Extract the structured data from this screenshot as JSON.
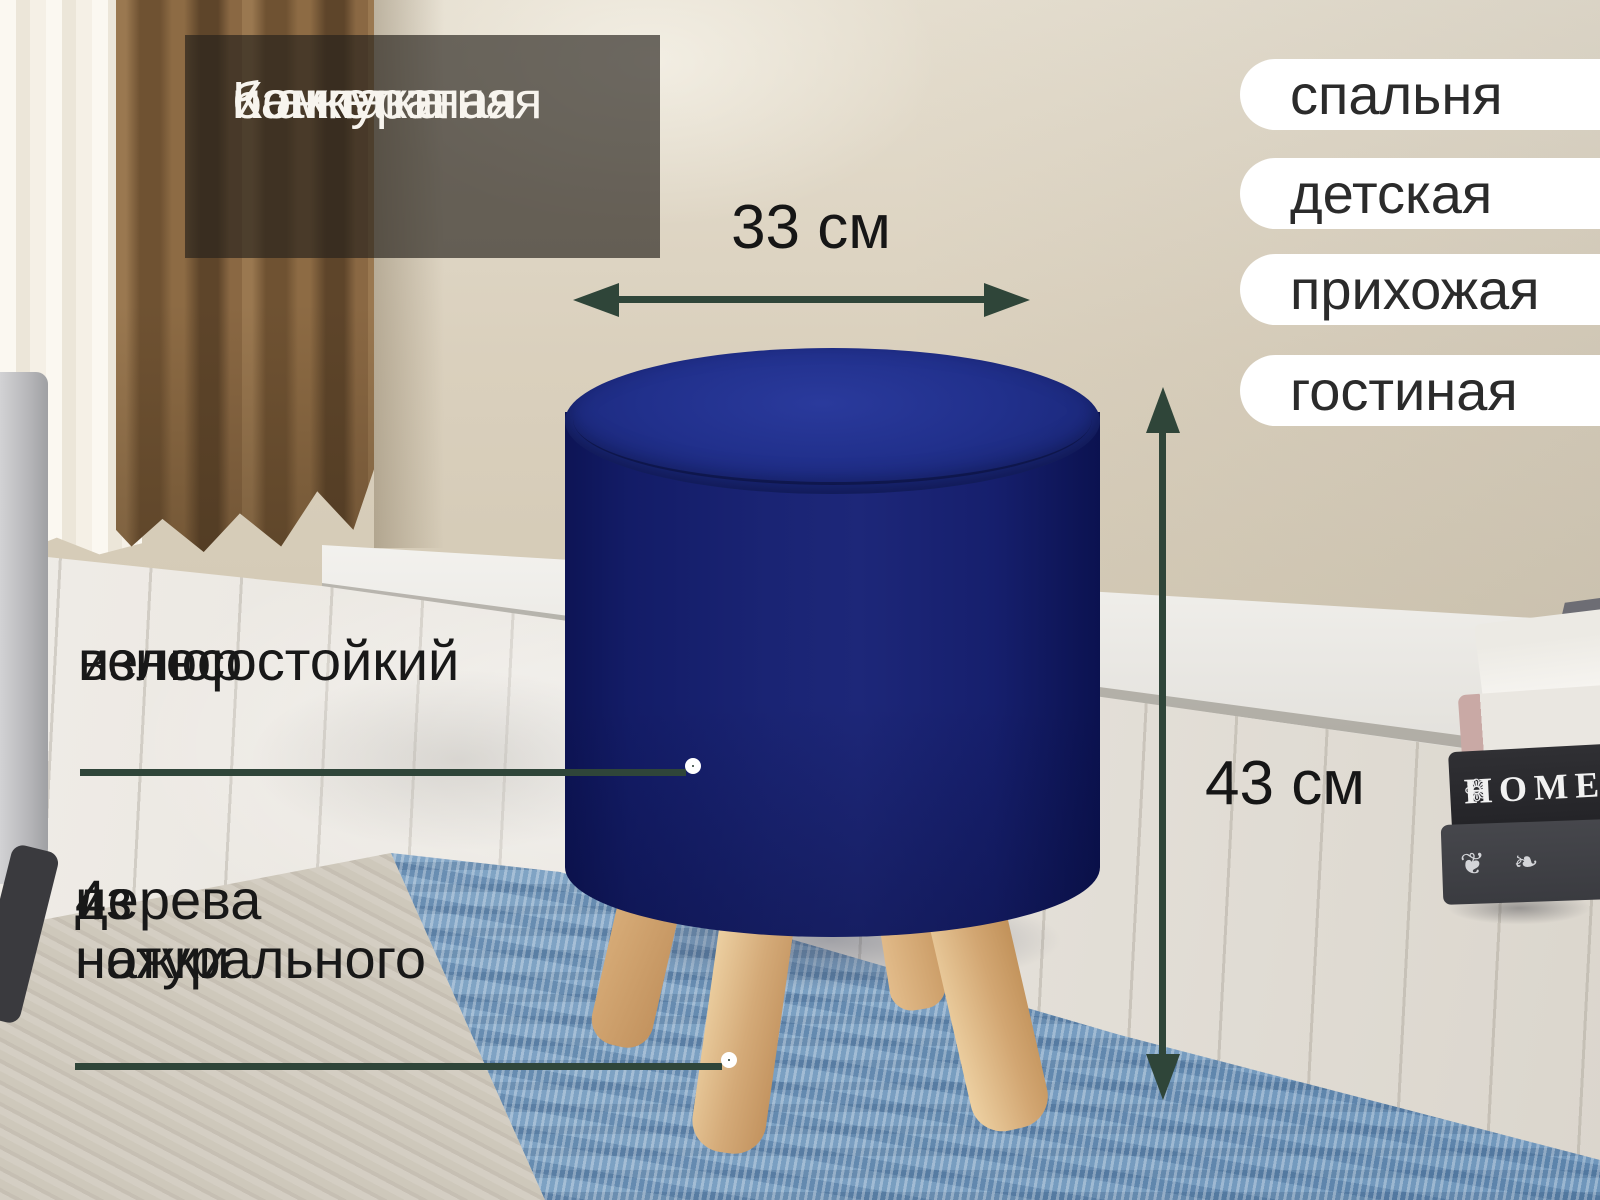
{
  "overlay_box": {
    "line1": "Компактная",
    "line2": "и аккуратная",
    "line3": "банкетка"
  },
  "room_tags": {
    "items": [
      {
        "label": "спальня"
      },
      {
        "label": "детская"
      },
      {
        "label": "прихожая"
      },
      {
        "label": "гостиная"
      }
    ]
  },
  "dimensions": {
    "width_label": "33 см",
    "height_label": "43 см"
  },
  "callouts": {
    "velour": {
      "line1": "износостойкий",
      "line2": "велюр"
    },
    "legs": {
      "line1": "4 ножки",
      "line2": "из натурального",
      "line3": "дерева"
    }
  },
  "books": {
    "spine_title": "HOME",
    "ornament_glyph": "❁",
    "flourish_glyphs": "❦ ❧"
  },
  "colors": {
    "accent_green": "#2f4539",
    "pouf_blue": "#1d2779",
    "leg_wood": "#d9b381",
    "rug_blue": "#7fa3c4",
    "wall_beige": "#d8ceba",
    "curtain_brown": "#7d5c38",
    "pill_bg": "#ffffff",
    "pill_text": "#2b2b2b",
    "label_text": "#161616",
    "overlay_text": "#f7f4ee"
  }
}
